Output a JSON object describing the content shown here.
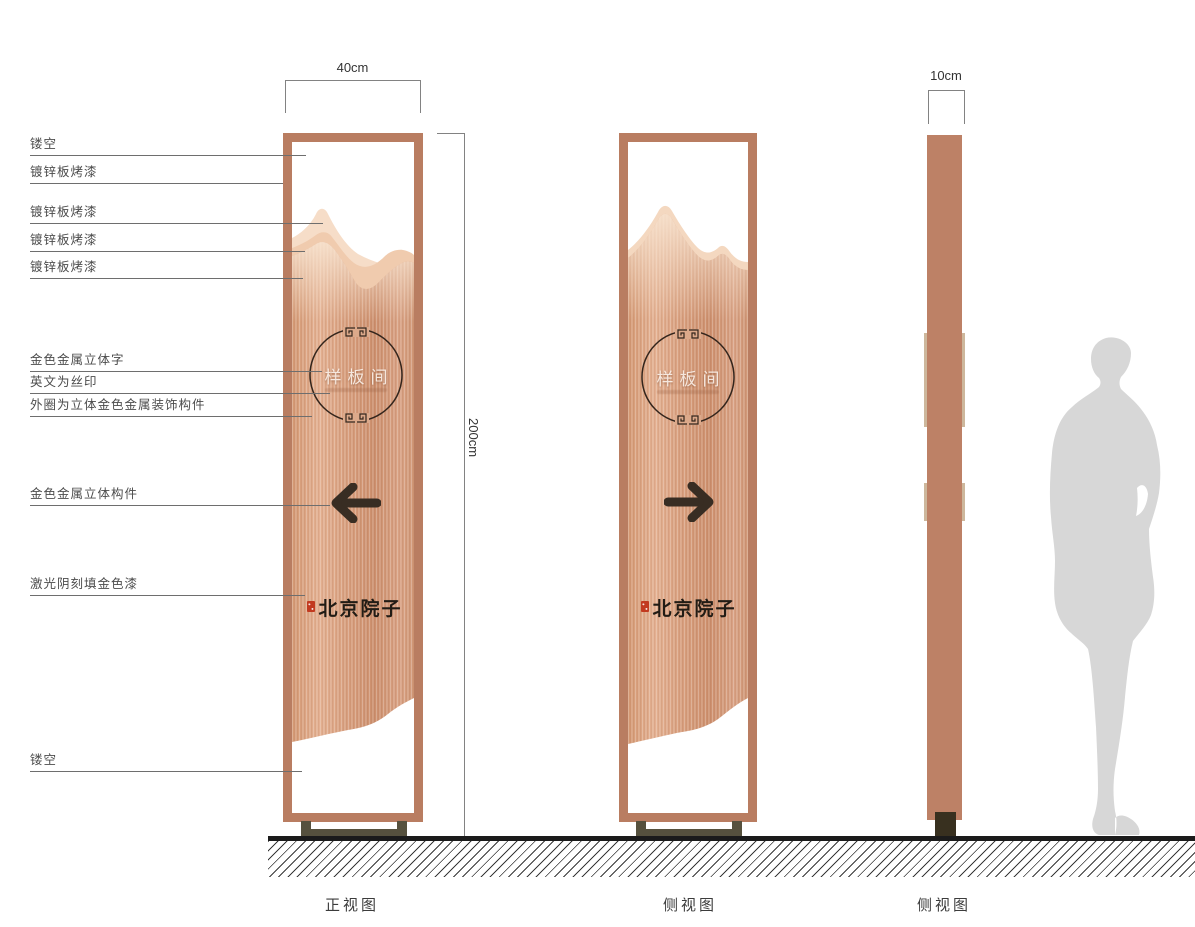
{
  "drawing": {
    "type": "signage-elevation-drawing"
  },
  "callouts": [
    {
      "label": "镂空"
    },
    {
      "label": "镀锌板烤漆"
    },
    {
      "label": "镀锌板烤漆"
    },
    {
      "label": "镀锌板烤漆"
    },
    {
      "label": "镀锌板烤漆"
    },
    {
      "label": "金色金属立体字"
    },
    {
      "label": "英文为丝印"
    },
    {
      "label": "外圈为立体金色金属装饰构件"
    },
    {
      "label": "金色金属立体构件"
    },
    {
      "label": "激光阴刻填金色漆"
    },
    {
      "label": "镂空"
    }
  ],
  "dimensions": {
    "front_width": "40cm",
    "height": "200cm",
    "side_depth": "10cm"
  },
  "views": {
    "front": {
      "caption": "正视图"
    },
    "side1": {
      "caption": "侧视图"
    },
    "side2": {
      "caption": "侧视图"
    }
  },
  "emblem": {
    "text": "样板间"
  },
  "brand": {
    "text": "北京院子"
  },
  "colors": {
    "frame_copper": "#b97d61",
    "panel_copper": "#d69d7b",
    "mountain_back": "#f6ddc8",
    "mountain_mid": "#f0cbae",
    "side_column": "#bd8166",
    "side_trim": "#cdb79c",
    "base_metal": "#56513e",
    "foot_dark": "#38301f",
    "arrow_ink": "#382d23",
    "seal_red": "#c23a20",
    "silhouette_gray": "#d7d7d7"
  }
}
